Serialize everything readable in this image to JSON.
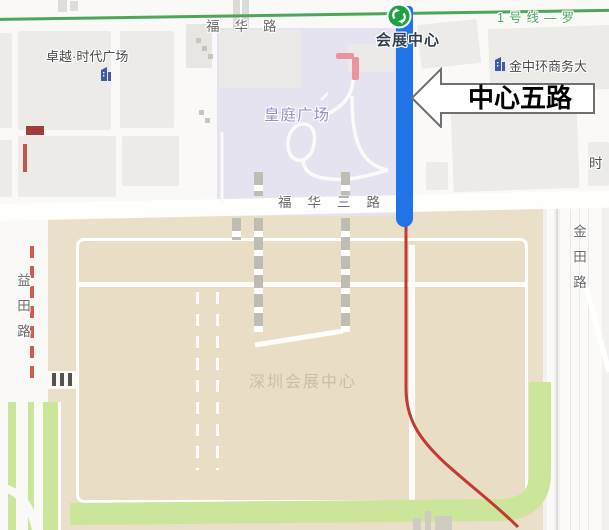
{
  "map": {
    "metro_line": {
      "name_label": "1号线—罗",
      "station": "会展中心"
    },
    "roads": {
      "fuhua": "福华路",
      "fuhua3": "福华三路",
      "yitian": "益田路",
      "jintian": "金田路",
      "right_edge_partial": "时"
    },
    "places": {
      "zhuoyue": "卓越·时代广场",
      "jinzhonghuan": "金中环商务大",
      "huangting": "皇庭广场",
      "szcec": "深圳会展中心"
    },
    "callout": {
      "label": "中心五路"
    },
    "colors": {
      "highlight_route_blue": "#2173E8",
      "metro_line_green": "#4CA75B",
      "secondary_route_red": "#C13A33",
      "park_green": "#CBE59B",
      "block_tan": "#EADFC9",
      "plaza_purple": "#E6E3F0",
      "station_icon_green": "#1FA244"
    }
  }
}
